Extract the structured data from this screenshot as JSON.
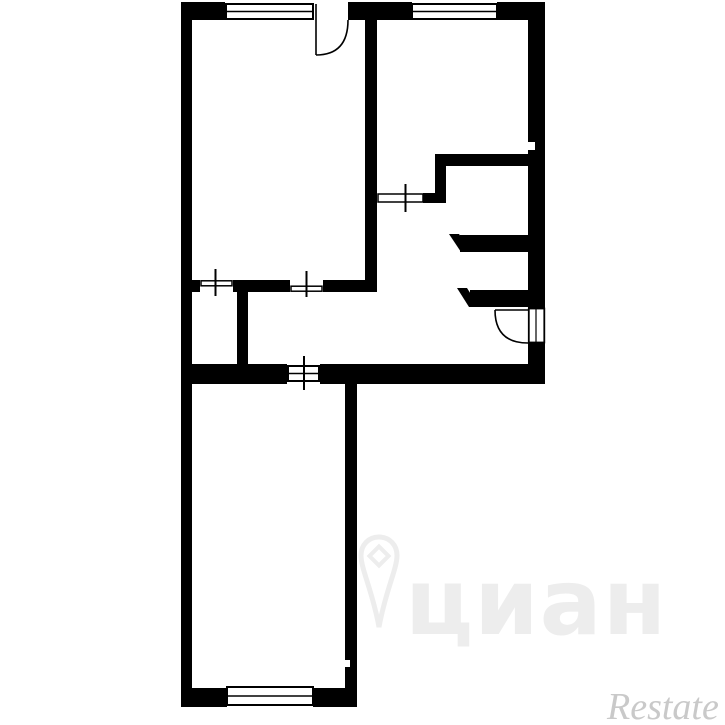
{
  "plan": {
    "ink_color": "#000000",
    "background_color": "#ffffff"
  },
  "watermarks": {
    "cian": {
      "text": "циан",
      "color": "#ededed",
      "icon": "location-pin-icon"
    },
    "restate": {
      "text": "Restate",
      "color": "#c9c9c9"
    }
  }
}
